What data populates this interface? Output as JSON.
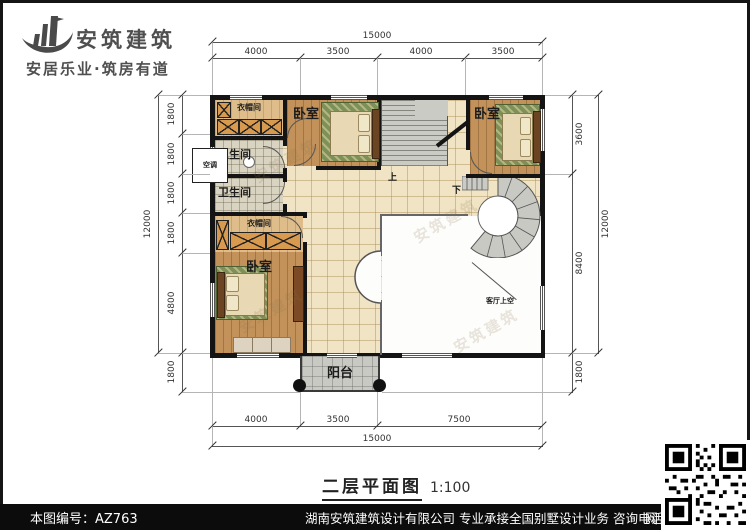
{
  "logo": {
    "company": "安筑建筑",
    "tagline": "安居乐业·筑房有道"
  },
  "plan": {
    "labels": {
      "bedroom": "卧室",
      "bathroom": "卫生间",
      "cloakroom": "衣帽间",
      "balcony": "阳台",
      "living_room_void": "客厅上空",
      "stair_up": "上",
      "stair_down": "下",
      "ac_unit": "空调"
    },
    "dimensions": {
      "top": {
        "overall": "15000",
        "segments": [
          "4000",
          "3500",
          "4000",
          "3500"
        ]
      },
      "bottom": {
        "overall": "15000",
        "segments": [
          "4000",
          "3500",
          "7500"
        ]
      },
      "left": {
        "overall": "12000",
        "segments": [
          "1800",
          "1800",
          "1800",
          "1800",
          "4800"
        ],
        "extra": "1800"
      },
      "right": {
        "overall": "12000",
        "segments": [
          "3600",
          "8400"
        ],
        "extra": "1800"
      }
    }
  },
  "title": {
    "name": "二层平面图",
    "scale": "1:100"
  },
  "watermark": {
    "text": "安筑建筑"
  },
  "footer": {
    "drawing_number": "本图编号：AZ763",
    "company_info": "湖南安筑建筑设计有限公司  专业承接全国别墅设计业务  咨询电话：400-8070-511",
    "qr_label": "网"
  },
  "colors": {
    "wall": "#141414",
    "wardrobe": "#d89a4f",
    "footer_bar": "#0c0c0c"
  }
}
